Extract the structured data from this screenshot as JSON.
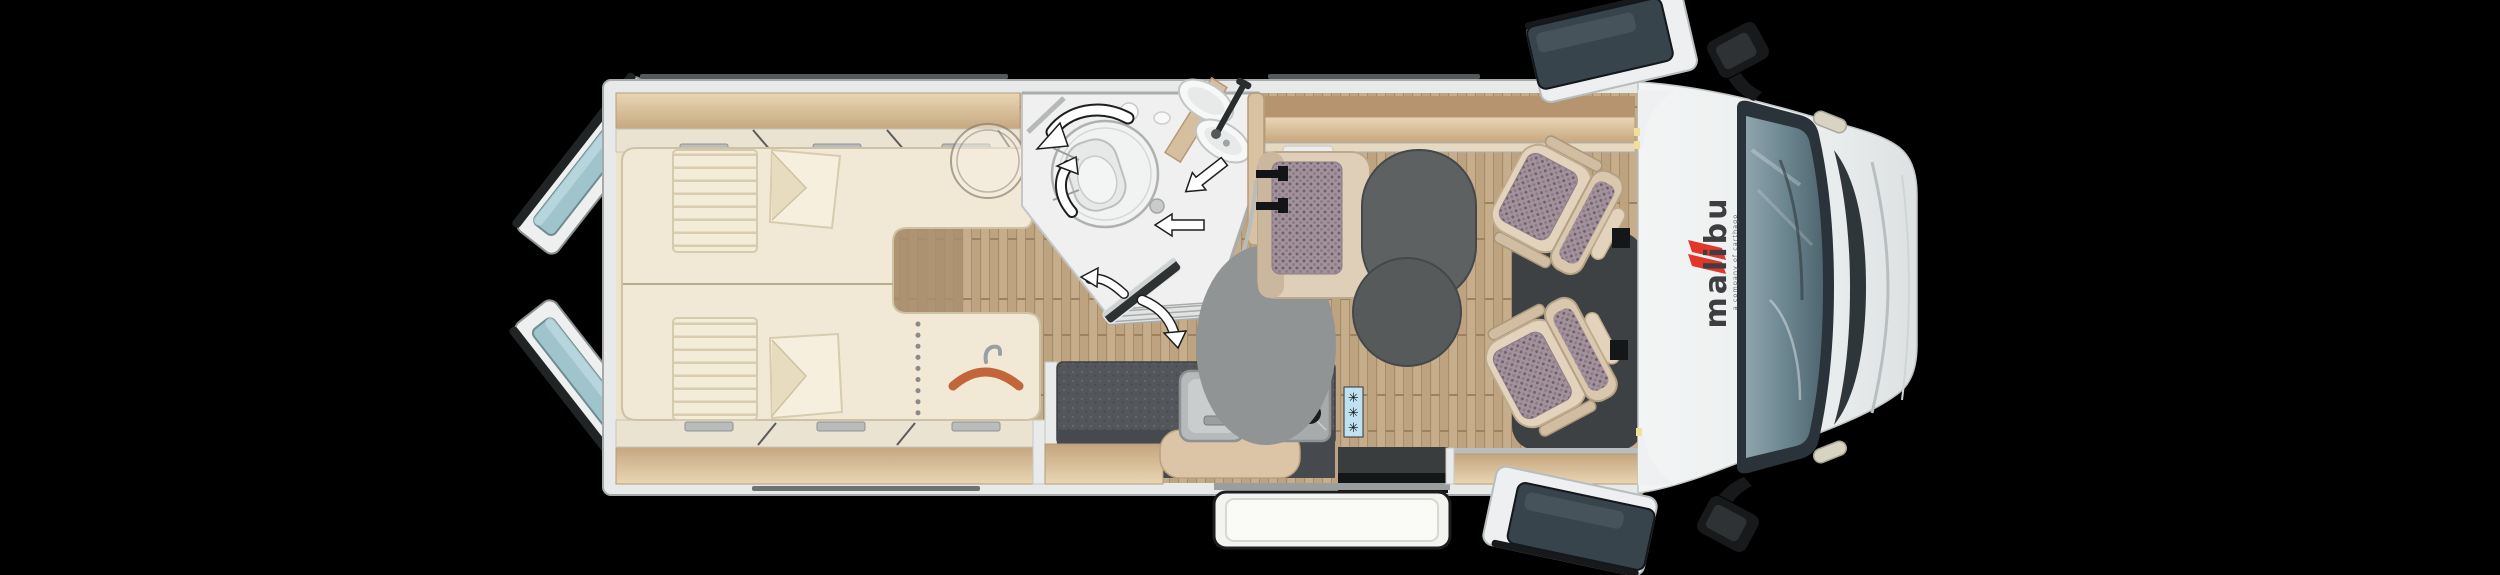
{
  "scene": {
    "background_color": "#000000",
    "view": "top-down motorhome floorplan"
  },
  "brand": {
    "logo_text": "malibu",
    "tagline": "a company of carthago",
    "logo_color": "#3e3e40",
    "accent_color": "#e2362b"
  },
  "fridge": {
    "badge_color": "#bfe2f2",
    "symbols": [
      "✳",
      "✳",
      "✳"
    ]
  },
  "icons": {
    "hanger-icon": "clothes hanger (wardrobe)",
    "snowflake-icon": "✳ fridge/freezer",
    "arrow-icon": "white swivel/door direction arrows",
    "ghost-table-icon": "translucent round side table"
  },
  "colors": {
    "body_white": "#eef0f1",
    "wall_gray": "#a6aaab",
    "floor_cream": "#ece3cb",
    "wood_light": "#dfc9a8",
    "wood_floor": "#c6ae8c",
    "counter_dark": "#53565a",
    "seat_beige": "#e0d0ba",
    "upholstery_mauve": "#a3929c",
    "table_gray": "#5e6162",
    "cab_mat": "#3e4143",
    "windshield": "#5b737d",
    "glass_teal": "#9fc4cb",
    "mirror_black": "#17191b",
    "hanger_orange": "#c2653b"
  }
}
